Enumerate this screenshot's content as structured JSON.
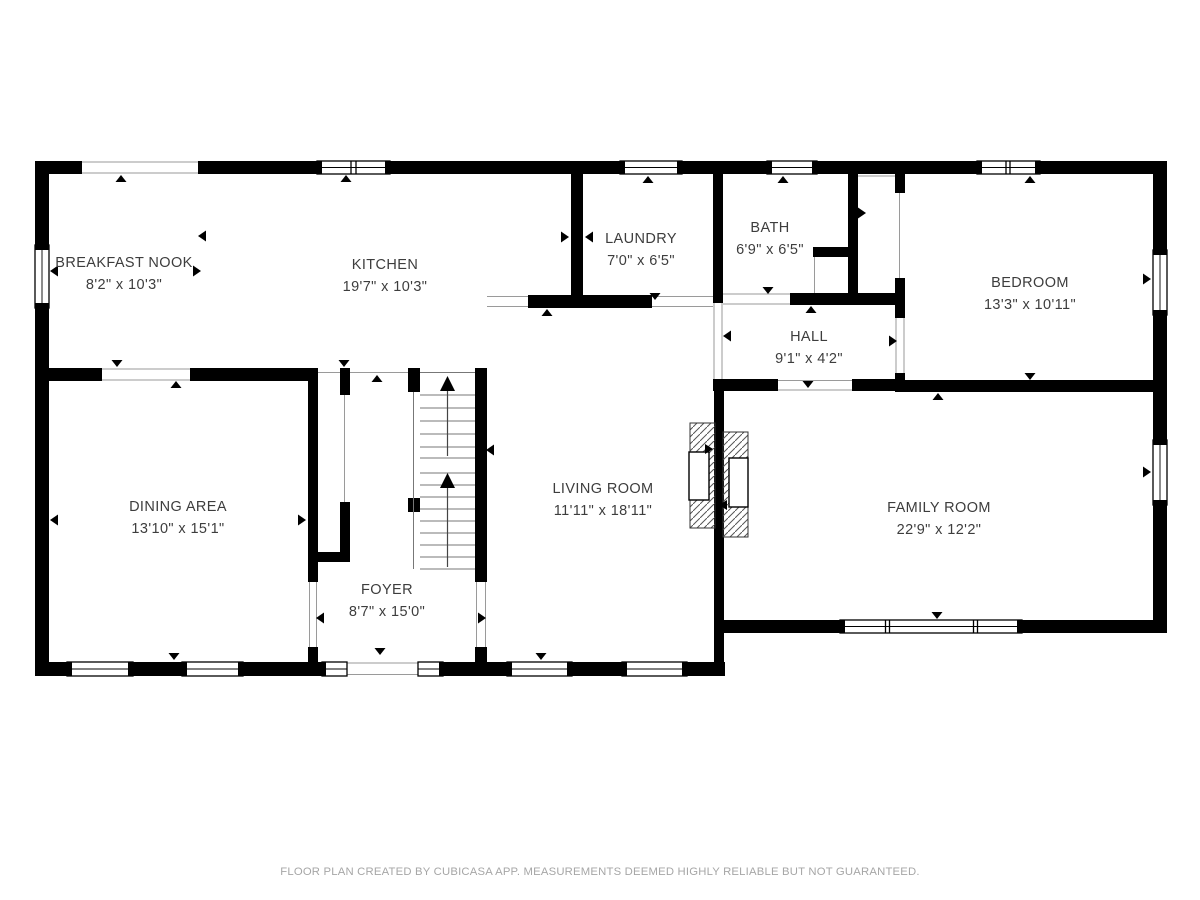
{
  "page": {
    "background": "#ffffff"
  },
  "floor_plan": {
    "wall_color": "#000000",
    "opening_line_color": "#9a9a9a",
    "label_color": "#3d3d3d",
    "rooms": [
      {
        "id": "breakfast-nook",
        "name": "BREAKFAST NOOK",
        "dimensions": "8'2\" x 10'3\""
      },
      {
        "id": "kitchen",
        "name": "KITCHEN",
        "dimensions": "19'7\" x 10'3\""
      },
      {
        "id": "laundry",
        "name": "LAUNDRY",
        "dimensions": "7'0\" x 6'5\""
      },
      {
        "id": "bath",
        "name": "BATH",
        "dimensions": "6'9\" x 6'5\""
      },
      {
        "id": "bedroom",
        "name": "BEDROOM",
        "dimensions": "13'3\" x 10'11\""
      },
      {
        "id": "hall",
        "name": "HALL",
        "dimensions": "9'1\" x 4'2\""
      },
      {
        "id": "dining-area",
        "name": "DINING AREA",
        "dimensions": "13'10\" x 15'1\""
      },
      {
        "id": "living-room",
        "name": "LIVING ROOM",
        "dimensions": "11'11\" x 18'11\""
      },
      {
        "id": "family-room",
        "name": "FAMILY ROOM",
        "dimensions": "22'9\" x 12'2\""
      },
      {
        "id": "foyer",
        "name": "FOYER",
        "dimensions": "8'7\" x 15'0\""
      }
    ],
    "features": [
      "stairs-up",
      "fireplace-double-sided",
      "windows",
      "door-openings"
    ]
  },
  "footer": {
    "disclaimer": "FLOOR PLAN CREATED BY CUBICASA APP. MEASUREMENTS DEEMED HIGHLY RELIABLE BUT NOT GUARANTEED."
  }
}
